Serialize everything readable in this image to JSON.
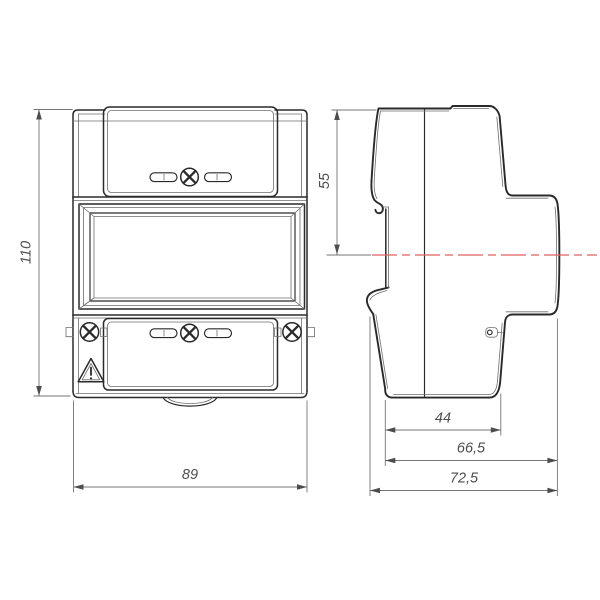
{
  "drawing": {
    "type": "technical-orthographic-drawing",
    "views": [
      "front-view",
      "side-view"
    ]
  },
  "dimensions": {
    "front_height": "110",
    "front_width": "89",
    "side_top_to_axis": "55",
    "side_depth_inner": "44",
    "side_depth_mid": "66,5",
    "side_depth_total": "72,5"
  },
  "colors": {
    "line_strong": "#2a2a2a",
    "line_thin": "#6e6e6e",
    "dimension": "#757575",
    "dimension_text": "#4d4d4d",
    "centerline_red": "#e06262",
    "background": "#ffffff"
  },
  "icons": {
    "warning_triangle": "triangle-with-exclamation",
    "screw": "phillips-cross-screw",
    "center_axis": "red-dash-dot-line"
  }
}
